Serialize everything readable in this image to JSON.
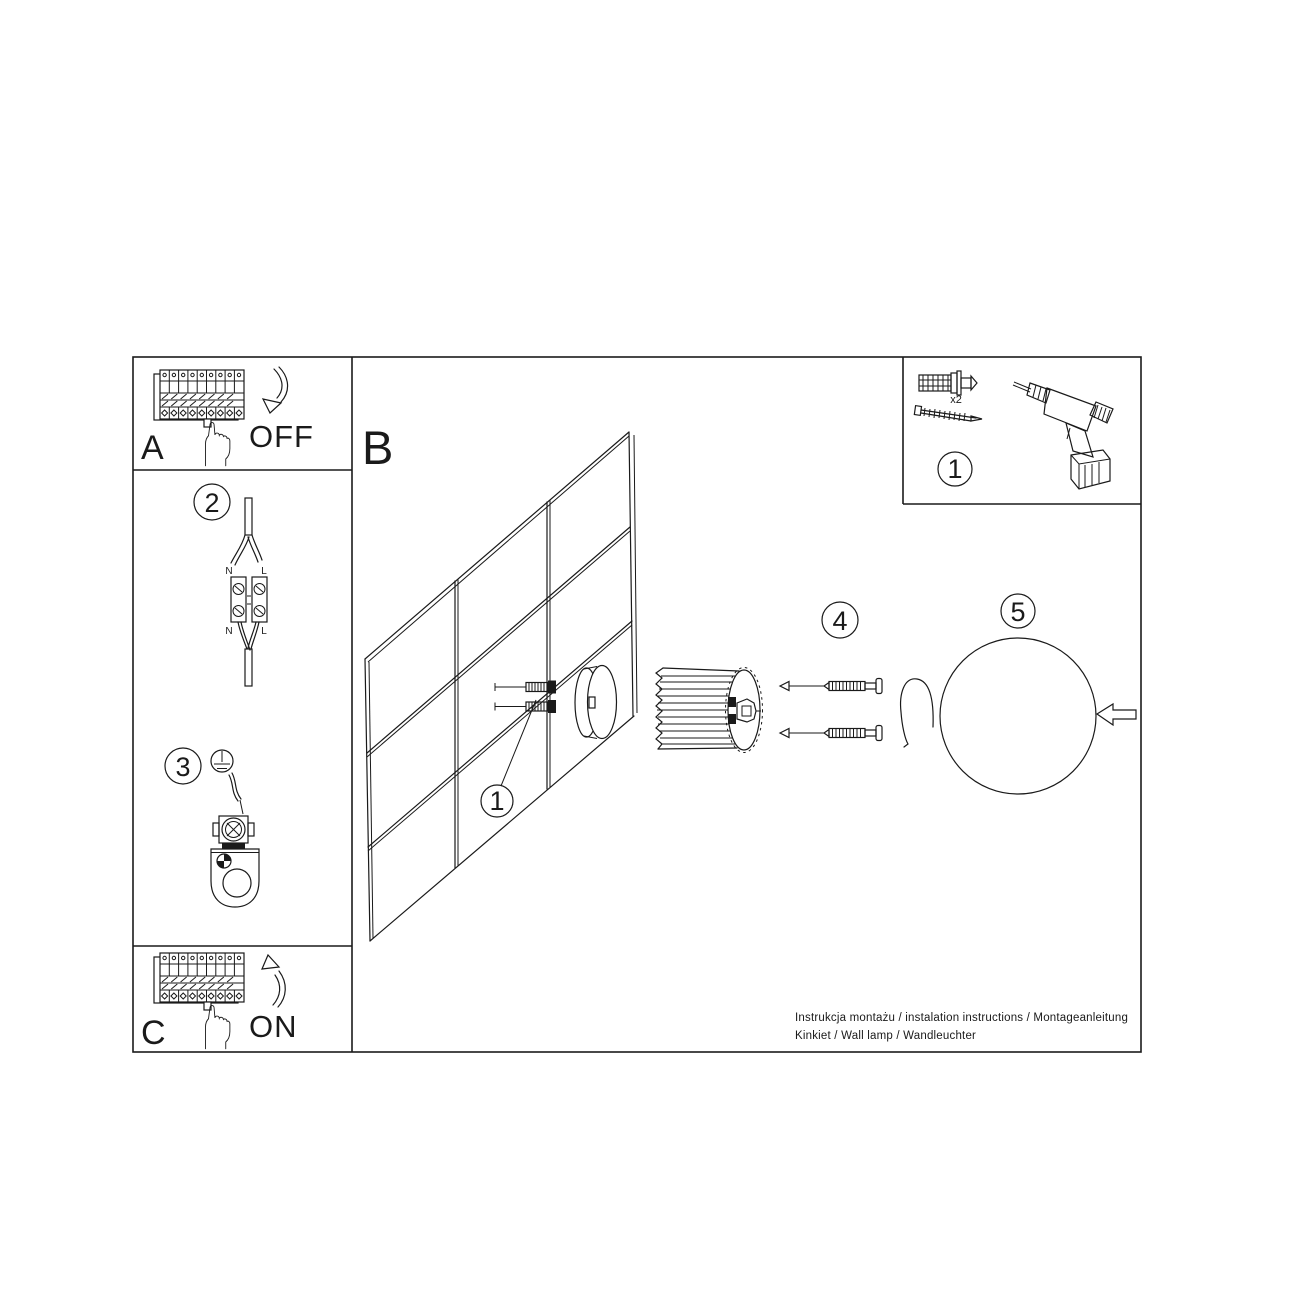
{
  "labels": {
    "section_a": "A",
    "section_b": "B",
    "section_c": "C",
    "switch_off": "OFF",
    "switch_on": "ON"
  },
  "steps": {
    "tools": "1",
    "anchors": "1",
    "wiring": "2",
    "ground": "3",
    "screws": "4",
    "shade": "5"
  },
  "wiring_labels": {
    "neutral": "N",
    "live": "L"
  },
  "hardware": {
    "anchor_quantity": "x2"
  },
  "footer": {
    "line1": "Instrukcja montażu / instalation instructions / Montageanleitung",
    "line2": "Kinkiet / Wall lamp / Wandleuchter"
  },
  "colors": {
    "ink": "#1a1a1a",
    "background": "#ffffff"
  }
}
